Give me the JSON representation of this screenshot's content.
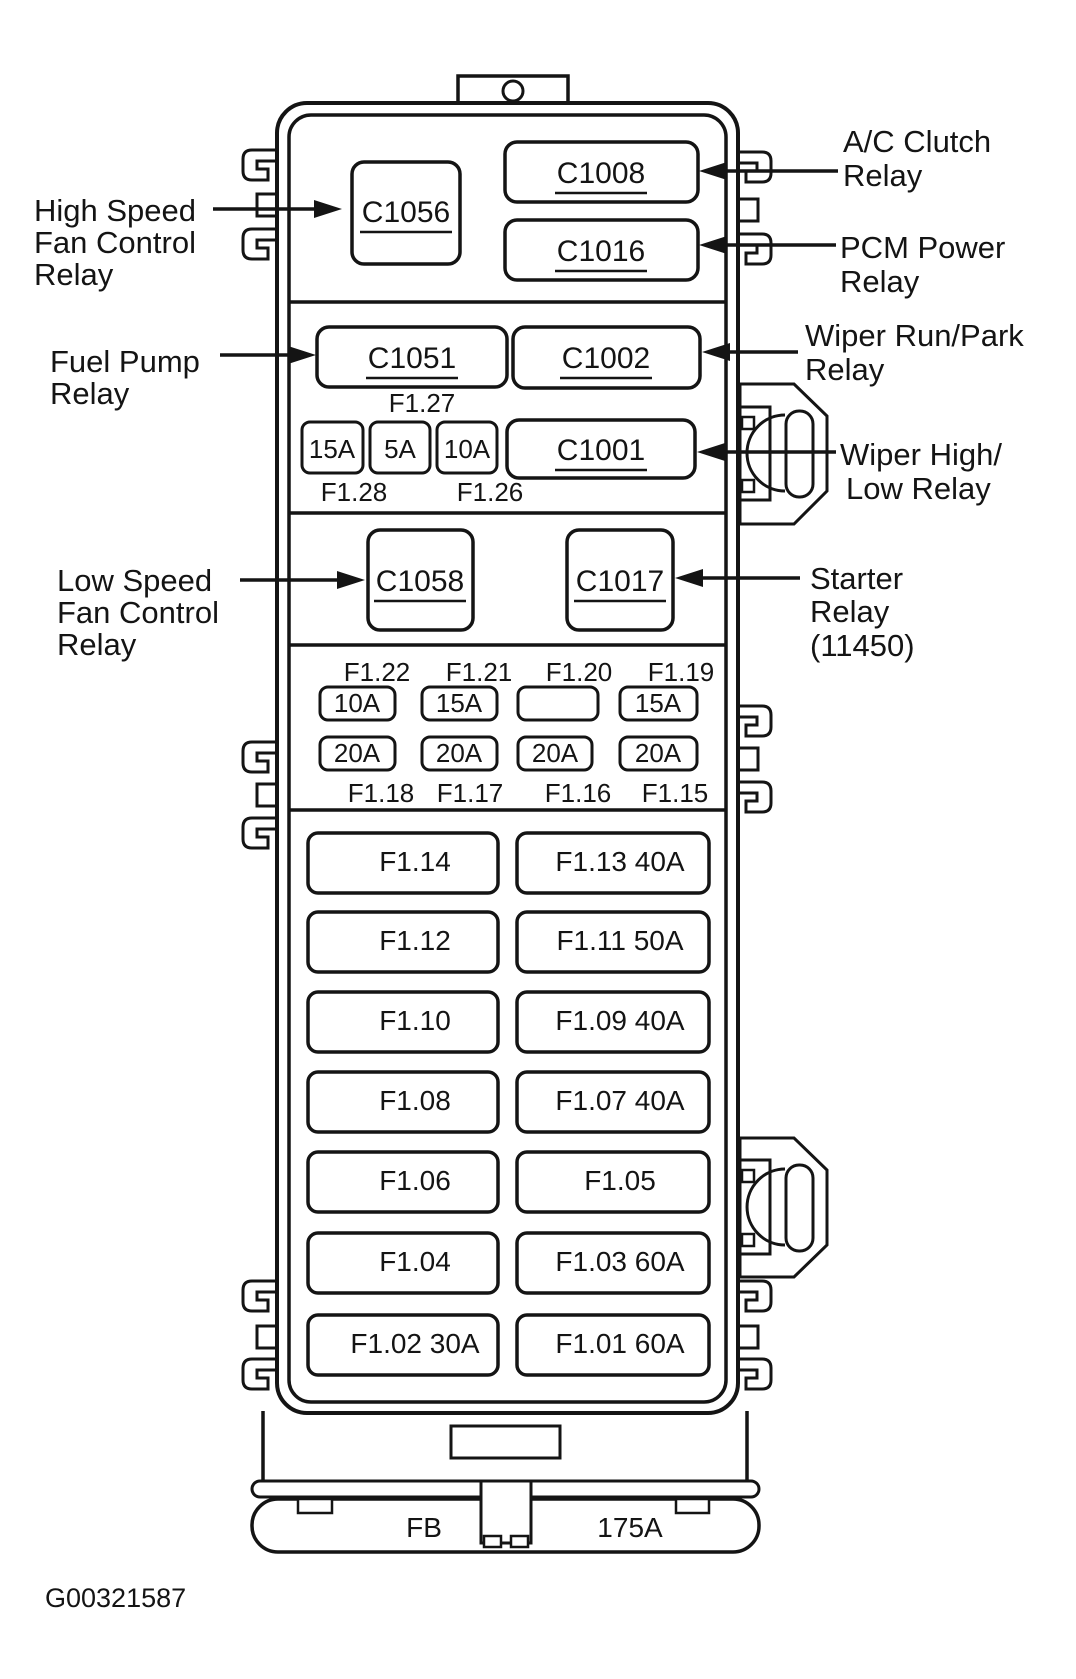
{
  "figure_code": "G00321587",
  "colors": {
    "line": "#141414",
    "background": "#ffffff"
  },
  "connectors": {
    "c1056": "C1056",
    "c1008": "C1008",
    "c1016": "C1016",
    "c1051": "C1051",
    "c1002": "C1002",
    "c1001": "C1001",
    "c1058": "C1058",
    "c1017": "C1017"
  },
  "callouts": {
    "high_speed_fan": [
      "High Speed",
      "Fan Control",
      "Relay"
    ],
    "fuel_pump": [
      "Fuel Pump",
      "Relay"
    ],
    "low_speed_fan": [
      "Low Speed",
      "Fan Control",
      "Relay"
    ],
    "ac_clutch": [
      "A/C Clutch",
      "Relay"
    ],
    "pcm_power": [
      "PCM Power",
      "Relay"
    ],
    "wiper_run_park": [
      "Wiper Run/Park",
      "Relay"
    ],
    "wiper_high_low": [
      "Wiper High/",
      "Low Relay"
    ],
    "starter": [
      "Starter",
      "Relay",
      "(11450)"
    ]
  },
  "fuse_row": {
    "top_label": "F1.27",
    "fuses": [
      "15A",
      "5A",
      "10A"
    ],
    "bottom_labels": [
      "F1.28",
      "F1.26"
    ]
  },
  "mini_grid": {
    "top_labels": [
      "F1.22",
      "F1.21",
      "F1.20",
      "F1.19"
    ],
    "row1": [
      "10A",
      "15A",
      "",
      "15A"
    ],
    "row2": [
      "20A",
      "20A",
      "20A",
      "20A"
    ],
    "bottom_labels": [
      "F1.18",
      "F1.17",
      "F1.16",
      "F1.15"
    ]
  },
  "large_fuses": {
    "left": [
      "F1.14",
      "F1.12",
      "F1.10",
      "F1.08",
      "F1.06",
      "F1.04",
      "F1.02 30A"
    ],
    "right": [
      "F1.13 40A",
      "F1.11 50A",
      "F1.09 40A",
      "F1.07 40A",
      "F1.05",
      "F1.03 60A",
      "F1.01 60A"
    ]
  },
  "base": {
    "fb_label": "FB",
    "amp_label": "175A"
  }
}
